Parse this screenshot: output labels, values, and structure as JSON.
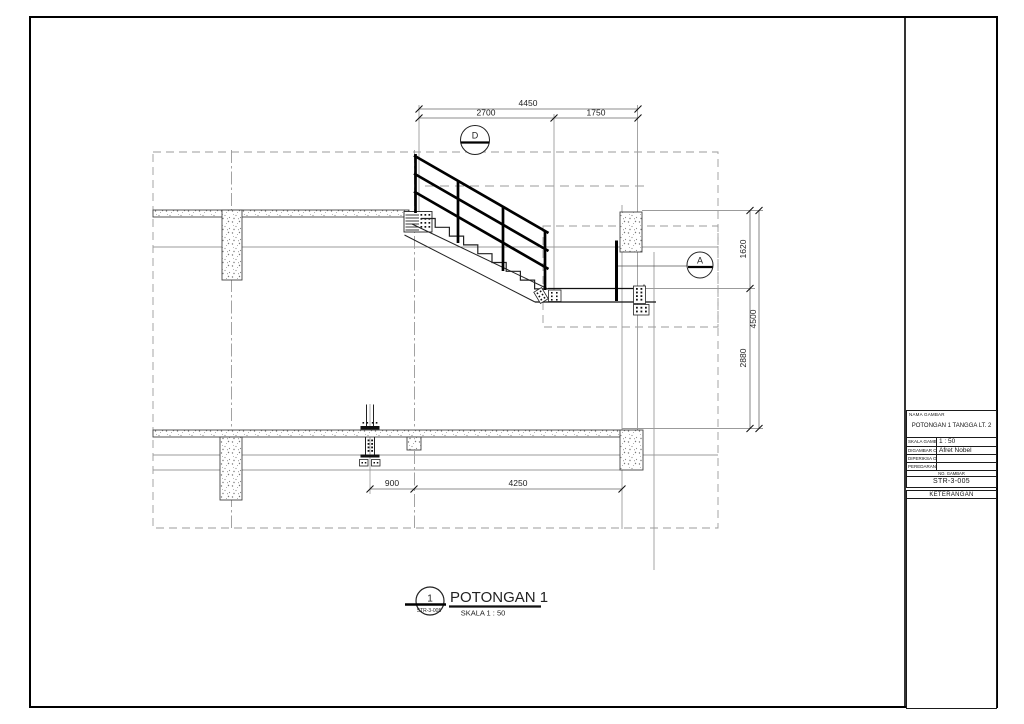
{
  "title_block": {
    "name_label": "NAMA GAMBAR",
    "drawing_name": "POTONGAN 1 TANGGA LT. 2",
    "fields": [
      {
        "label": "SKALA GAMBAR",
        "value": "1 : 50"
      },
      {
        "label": "DIGAMBAR OLEH",
        "value": "Afret Nobel"
      },
      {
        "label": "DIPERIKSA OLEH",
        "value": ""
      },
      {
        "label": "PEREDARAN UNTUK",
        "value": ""
      }
    ],
    "number_label": "NO. GAMBAR",
    "drawing_number": "STR-3-005",
    "notes_label": "KETERANGAN"
  },
  "view_title": {
    "bubble_number": "1",
    "bubble_sheet": "STR-3-005",
    "title": "POTONGAN 1",
    "scale": "SKALA 1 : 50"
  },
  "dimensions": {
    "top_total": "4450",
    "top_segments": [
      "2700",
      "1750"
    ],
    "right_total": "4500",
    "right_segments": [
      "1620",
      "2880"
    ],
    "bottom_segments": [
      "900",
      "4250"
    ]
  },
  "markers": {
    "detail_d": "D",
    "detail_a": "A"
  },
  "colors": {
    "line": "#1a1a1a",
    "construction": "#9b9b9b",
    "dimension": "#666666"
  }
}
